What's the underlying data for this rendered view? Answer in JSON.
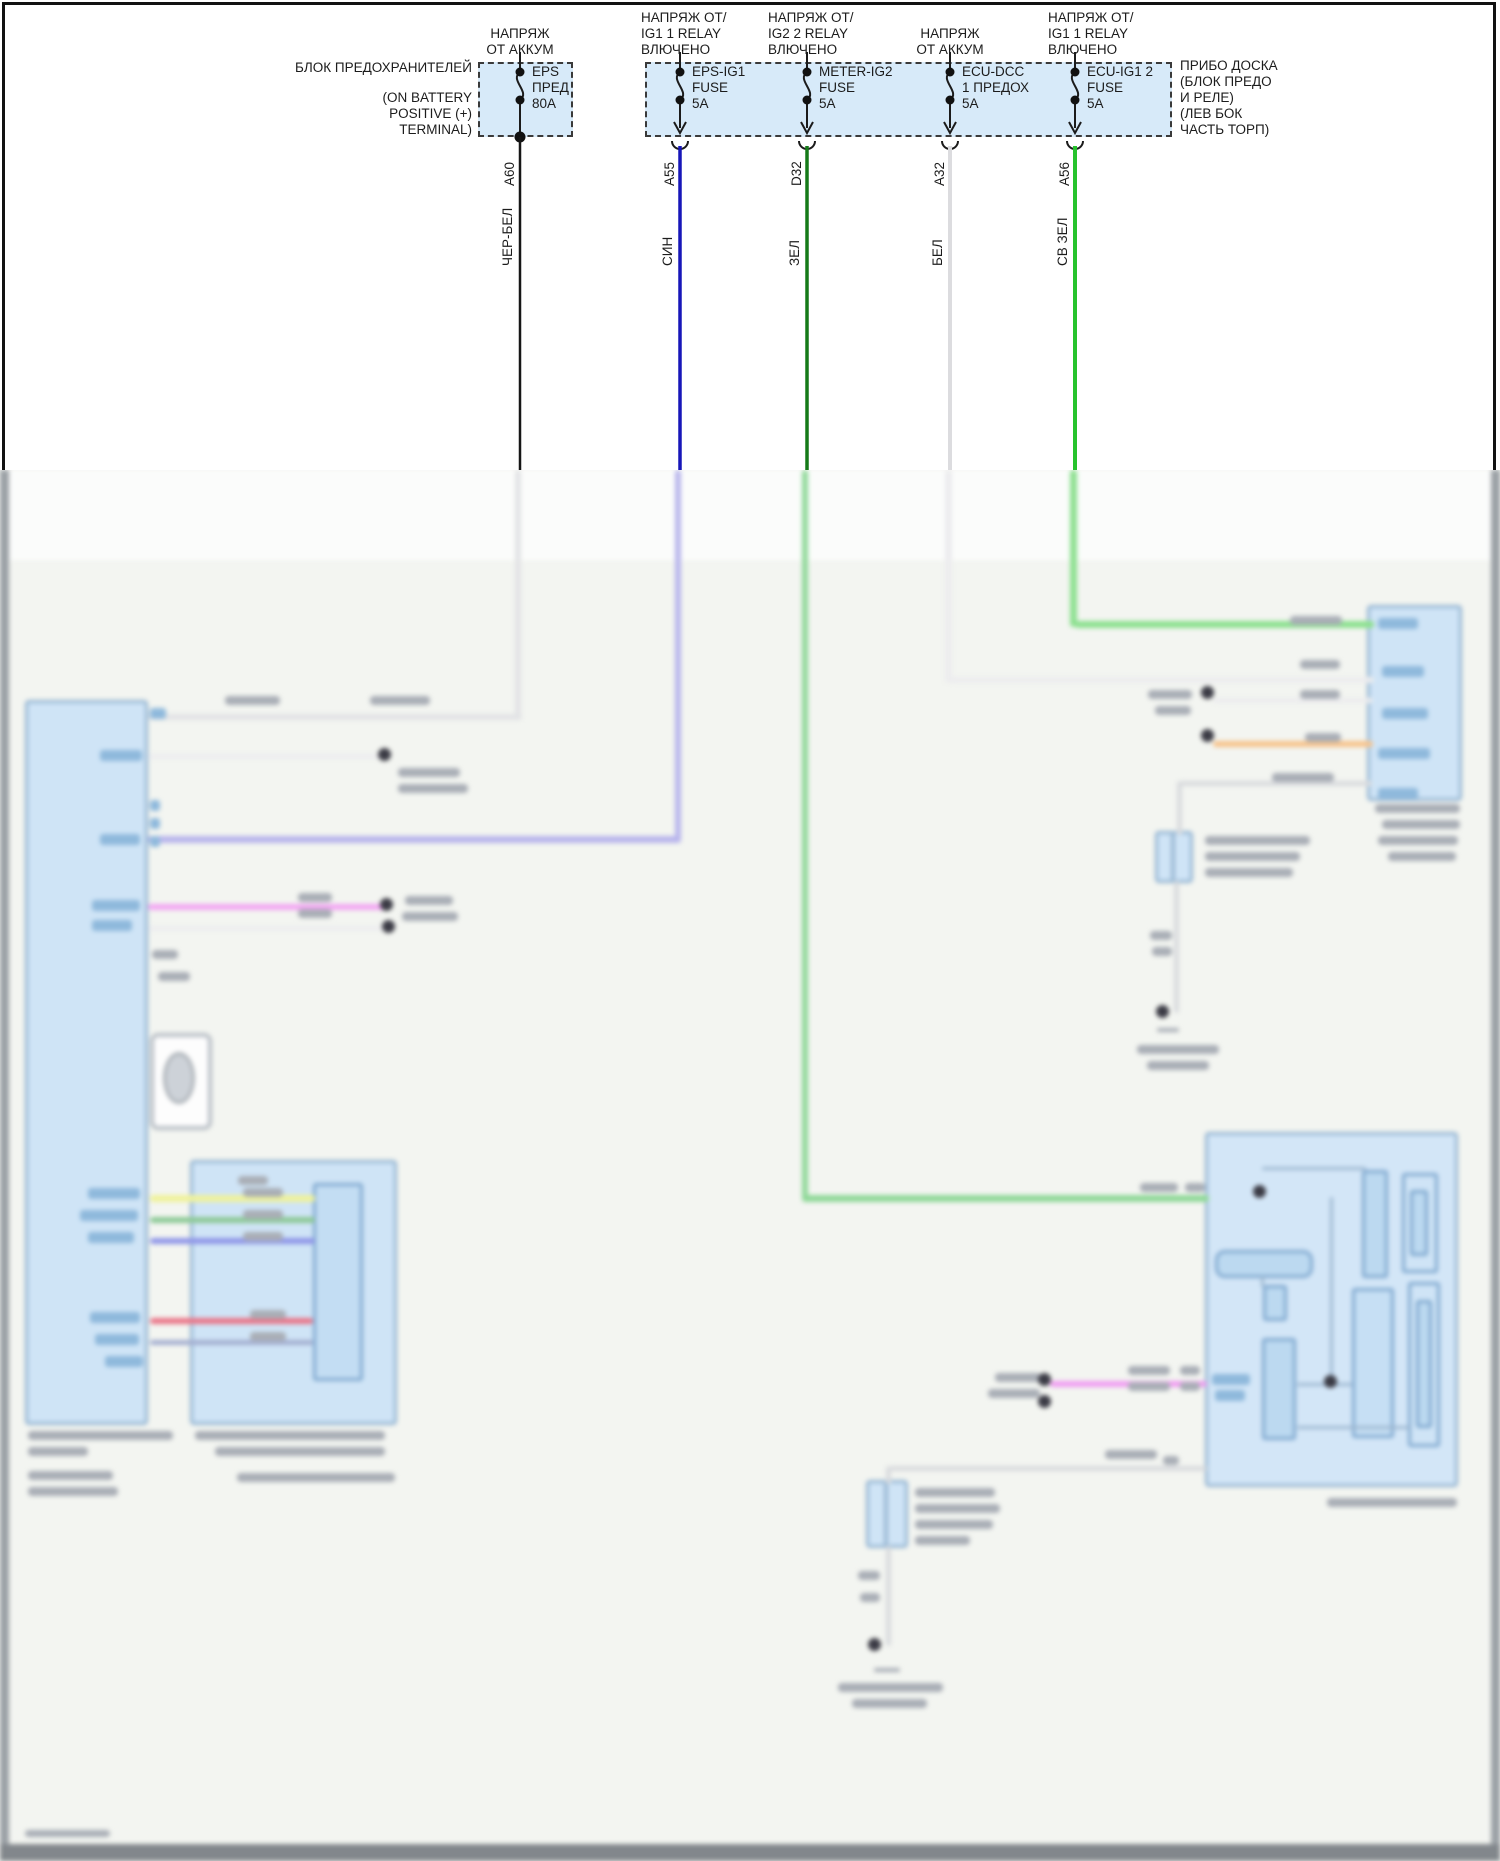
{
  "fuse_area": {
    "left_block_label": "БЛОК ПРЕДОХРАНИТЕЛЕЙ",
    "left_block_sublabel": "(ON BATTERY\nPOSITIVE (+)\nTERMINAL)",
    "right_block_label": "ПРИБО ДОСКА\n(БЛОК ПРЕДО\nИ РЕЛЕ)\n(ЛЕВ БОК\nЧАСТЬ ТОРП)",
    "fuses": [
      {
        "header": "НАПРЯЖ\nОТ АККУМ",
        "name": "EPS\nПРЕД\n80A",
        "pin": "A60",
        "wire_color": "ЧЕР-БЕЛ"
      },
      {
        "header": "НАПРЯЖ ОТ/\nIG1 1 RELAY\nВЛЮЧЕНО",
        "name": "EPS-IG1\nFUSE\n5A",
        "pin": "A55",
        "wire_color": "СИН"
      },
      {
        "header": "НАПРЯЖ ОТ/\nIG2 2 RELAY\nВЛЮЧЕНО",
        "name": "METER-IG2\nFUSE\n5A",
        "pin": "D32",
        "wire_color": "ЗЕЛ"
      },
      {
        "header": "НАПРЯЖ\nОТ АККУМ",
        "name": "ECU-DCC\n1 ПРЕДОХ\n5A",
        "pin": "A32",
        "wire_color": "БЕЛ"
      },
      {
        "header": "НАПРЯЖ ОТ/\nIG1 1 RELAY\nВЛЮЧЕНО",
        "name": "ECU-IG1 2\nFUSE\n5A",
        "pin": "A56",
        "wire_color": "СВ ЗЕЛ"
      }
    ]
  },
  "colors": {
    "fuse_box_fill": "#d7eaf9",
    "wire_black": "#161616",
    "wire_blue": "#1716b8",
    "wire_green": "#157a18",
    "wire_white": "#dcdcdf",
    "wire_light_green": "#27c32d",
    "scan_background": "#f3f5f1",
    "component_fill": "#cfe4f6"
  }
}
